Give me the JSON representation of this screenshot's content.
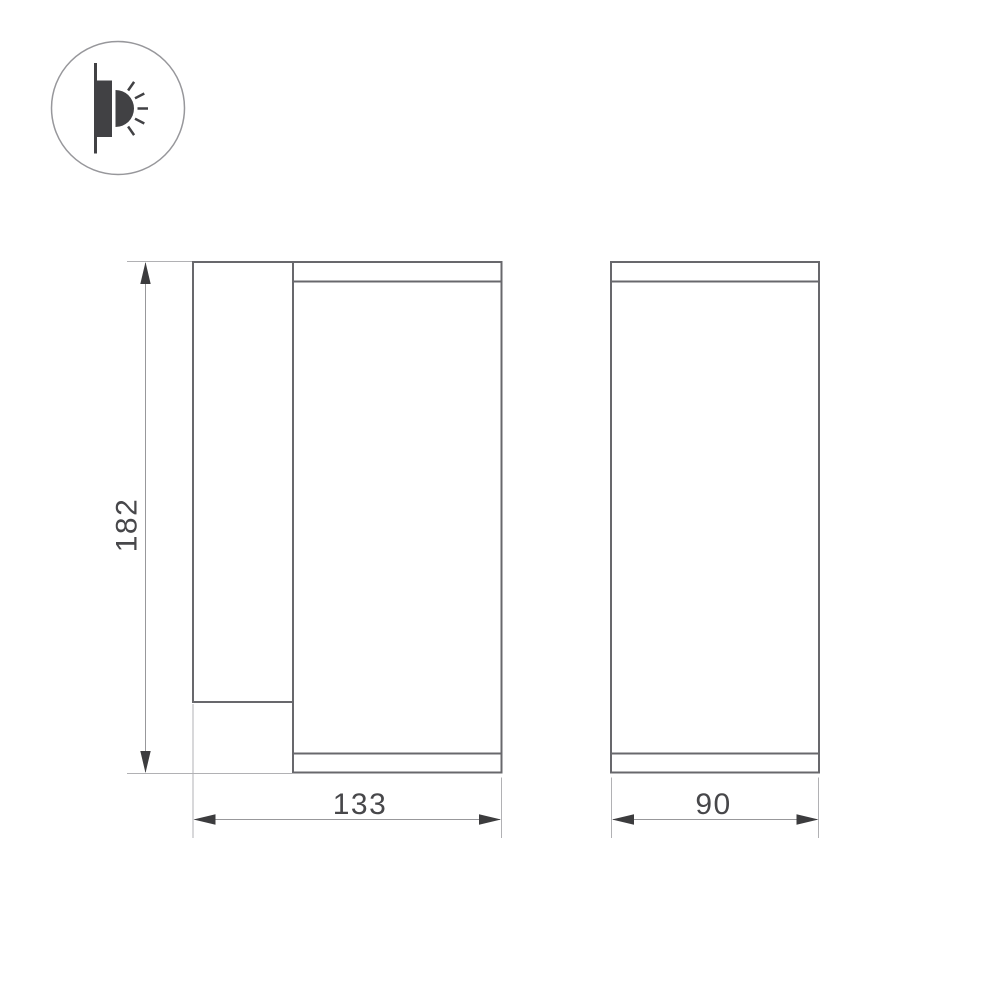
{
  "drawing": {
    "name": "wall-luminaire-dimension-drawing",
    "background": "#ffffff",
    "icon": {
      "name": "wall-mounted-light-side-emission-icon"
    },
    "views": [
      {
        "name": "side-view"
      },
      {
        "name": "front-view"
      }
    ],
    "dimensions": {
      "height": {
        "value": "182"
      },
      "width": {
        "value": "133"
      },
      "depth": {
        "value": "90"
      }
    },
    "colors": {
      "outline": "#68686c",
      "extension_line": "#b1b1b4",
      "dimension_line": "#98989b",
      "arrow": "#3c3c3e",
      "text": "#47474a",
      "icon_dark": "#414144",
      "icon_circle_border": "#97979b"
    }
  }
}
